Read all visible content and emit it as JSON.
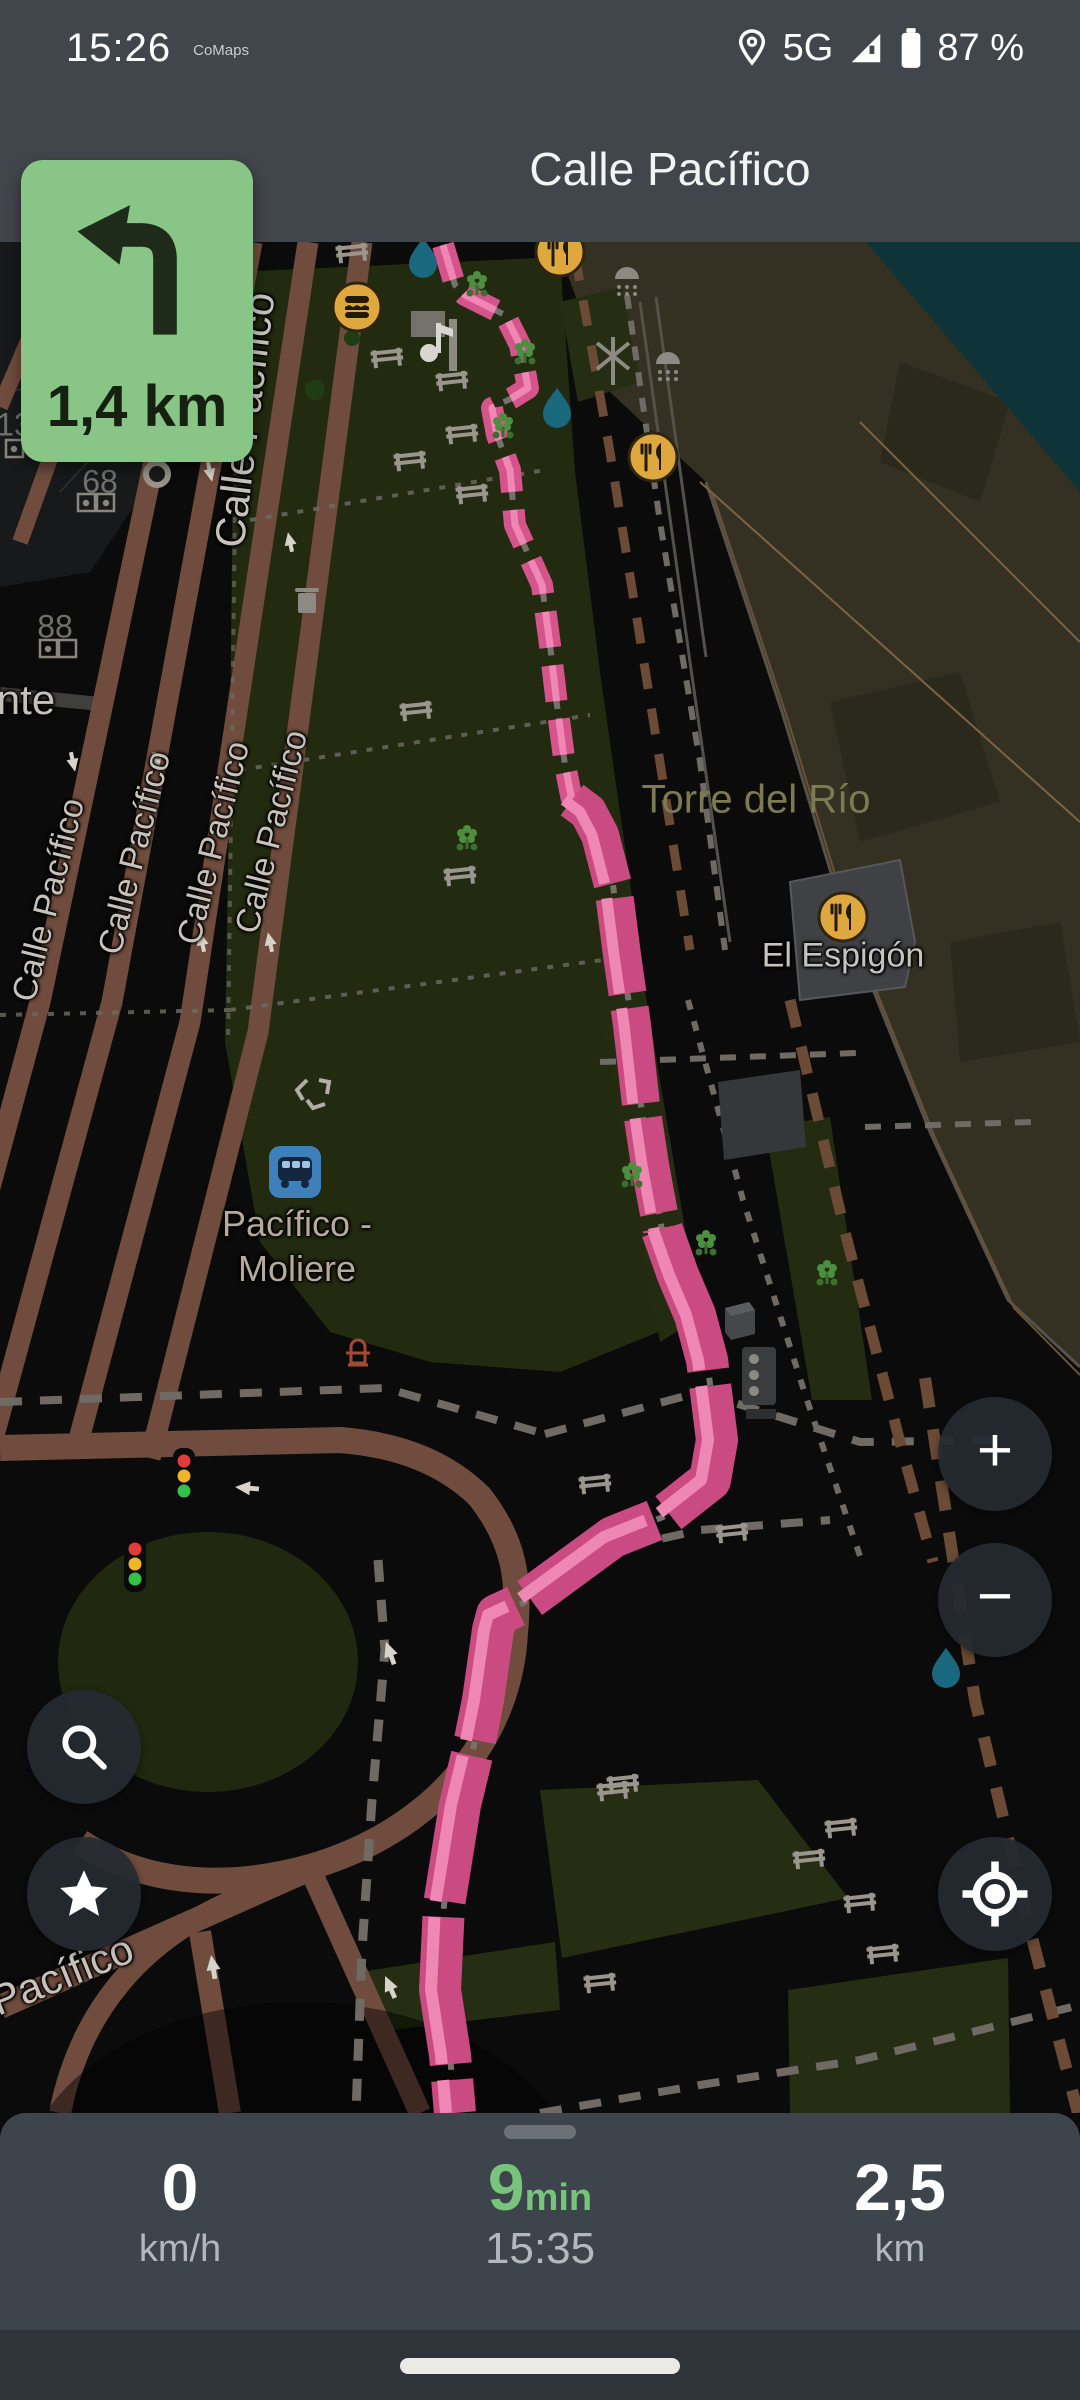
{
  "status_bar": {
    "time": "15:26",
    "app_label": "CoMaps",
    "network": "5G",
    "battery": "87 %"
  },
  "nav_header": {
    "title": "Calle Pacífico"
  },
  "turn_banner": {
    "direction": "turn-left",
    "distance": "1,4 km",
    "bg_color": "#89c587"
  },
  "map": {
    "labels": {
      "street": "Calle Pacífico",
      "area": "Torre del Río",
      "poi": "El Espigón",
      "bus_stop_line1": "Pacífico -",
      "bus_stop_line2": "Moliere",
      "street_bottom": "Pacífico",
      "street_partial": "nte",
      "house_numbers": [
        "13",
        "68",
        "88"
      ]
    },
    "icons": [
      "restaurant-icon",
      "fast-food-icon",
      "bus-stop-icon",
      "drinking-water-icon",
      "bench-icon",
      "traffic-signal-icon",
      "windmill-icon",
      "shower-icon",
      "waste-basket-icon",
      "recycling-icon",
      "fire-hydrant-icon",
      "playground-icon",
      "flower-icon",
      "entrance-icon"
    ],
    "colors": {
      "route_pink": "#c94b81",
      "route_stripe": "#ee87b4",
      "road_brown": "#6f4c3d",
      "park_green": "#222a10",
      "beach_olive": "#343122",
      "water_teal": "#0e3338",
      "poi_amber": "#dfa83e",
      "bus_blue": "#3f7fba"
    }
  },
  "map_controls": {
    "zoom_in": "+",
    "zoom_out": "−"
  },
  "bottom_bar": {
    "speed_value": "0",
    "speed_unit": "km/h",
    "eta_value": "9",
    "eta_unit": "min",
    "arrival_time": "15:35",
    "distance_value": "2,5",
    "distance_unit": "km"
  }
}
